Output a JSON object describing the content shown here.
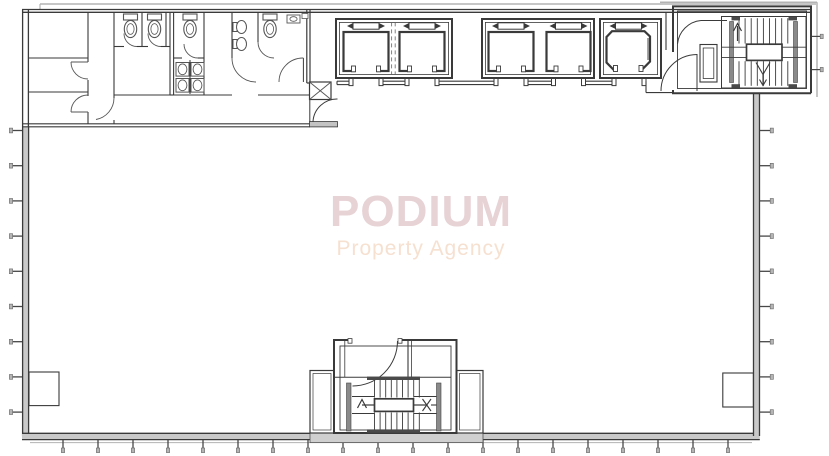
{
  "watermark": {
    "title": "PODIUM",
    "subtitle": "Property Agency",
    "title_color": "#e7d2d5",
    "subtitle_color": "#f6e0d0"
  },
  "drawing": {
    "type": "architectural-floor-plan",
    "background_color": "#ffffff",
    "line_color": "#3a3a3a",
    "fixture_line_color": "#555555",
    "wall_fill_color": "#c9c9c9",
    "light_line_color": "#b3b3b3",
    "dark_band_color": "#4a4a4a",
    "elevators": {
      "total": 5,
      "banks": [
        {
          "name": "elevator-bank-1",
          "cars": 2
        },
        {
          "name": "elevator-bank-2",
          "cars": 2
        },
        {
          "name": "elevator-bank-3",
          "cars": 1
        }
      ]
    },
    "stairs": [
      {
        "name": "north-east-stair"
      },
      {
        "name": "south-central-stair"
      }
    ],
    "washrooms": {
      "wc_cubicles": 3,
      "accessible_wc": 1,
      "urinals": 2,
      "basins": 4
    },
    "mullion_ticks": {
      "left": 9,
      "right": 9,
      "bottom": 20
    }
  }
}
